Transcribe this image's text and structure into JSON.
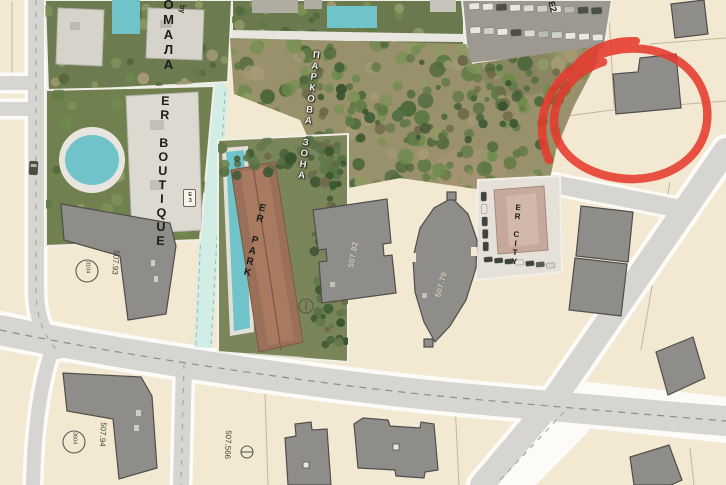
{
  "map": {
    "type": "development-site-plan",
    "labels": {
      "residence": "ОМАЛА",
      "residence_by": "by",
      "er_boutique": "ER BOUTIQUE",
      "park_zone": "ПАРКОВА ЗОНА",
      "er_park": "ER PARK",
      "er_city": "ER CITY",
      "block_e2": "E2",
      "block_e3": "ЕЗ",
      "elev_93": "507.93",
      "elev_94": "507.94",
      "elev_566": "507.566",
      "bldg_82": "507.82",
      "bldg_79": "507.79",
      "marker_a": "3104",
      "marker_b": "3604"
    },
    "annotation": {
      "kind": "hand-drawn red circle highlighting a building plot",
      "color": "#e63a2e"
    },
    "colors": {
      "parcel_beige": "#f3e9d2",
      "road_gray": "#d6d5d1",
      "building_gray": "#8e8d8a",
      "boundary_cyan": "#d2ede6",
      "annotation_red": "#e63a2e"
    }
  }
}
